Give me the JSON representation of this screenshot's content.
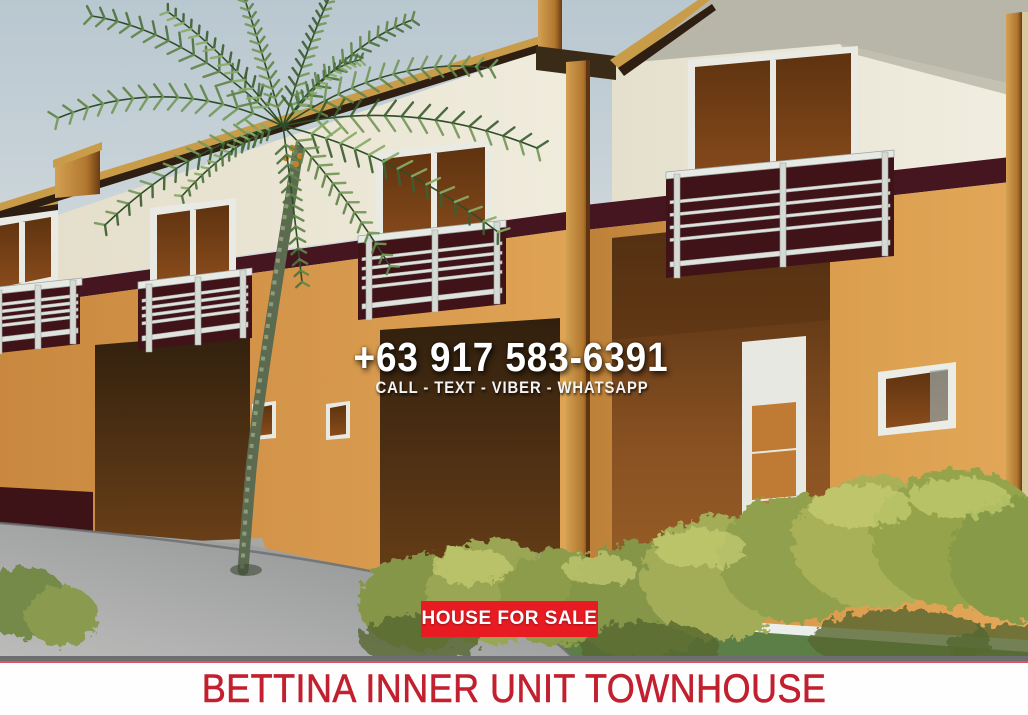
{
  "overlay": {
    "phone_number": "+63 917 583-6391",
    "contact_methods": "CALL - TEXT - VIBER - WHATSAPP",
    "sale_badge_label": "HOUSE FOR SALE"
  },
  "footer": {
    "title": "BETTINA INNER UNIT TOWNHOUSE"
  },
  "scene": {
    "subject": "3D render of a two-storey townhouse row with palm tree, shrubs, grass strip and curved gray road",
    "colors": {
      "badge_red": "#e81b23",
      "footer_title_red": "#c2202f",
      "overlay_text_white": "#ffffff",
      "wall_orange": "#dda156",
      "wall_cream": "#ebe6d6",
      "accent_maroon": "#451520",
      "roof_gold": "#c89c49",
      "window_glass_brown": "#7a4418",
      "palm_green": "#5f854a",
      "bush_yellow_green": "#a3ad58",
      "grass_green": "#5b7f46",
      "road_gray": "#989a9b",
      "sky_blue_gray": "#c3cfd6"
    }
  }
}
